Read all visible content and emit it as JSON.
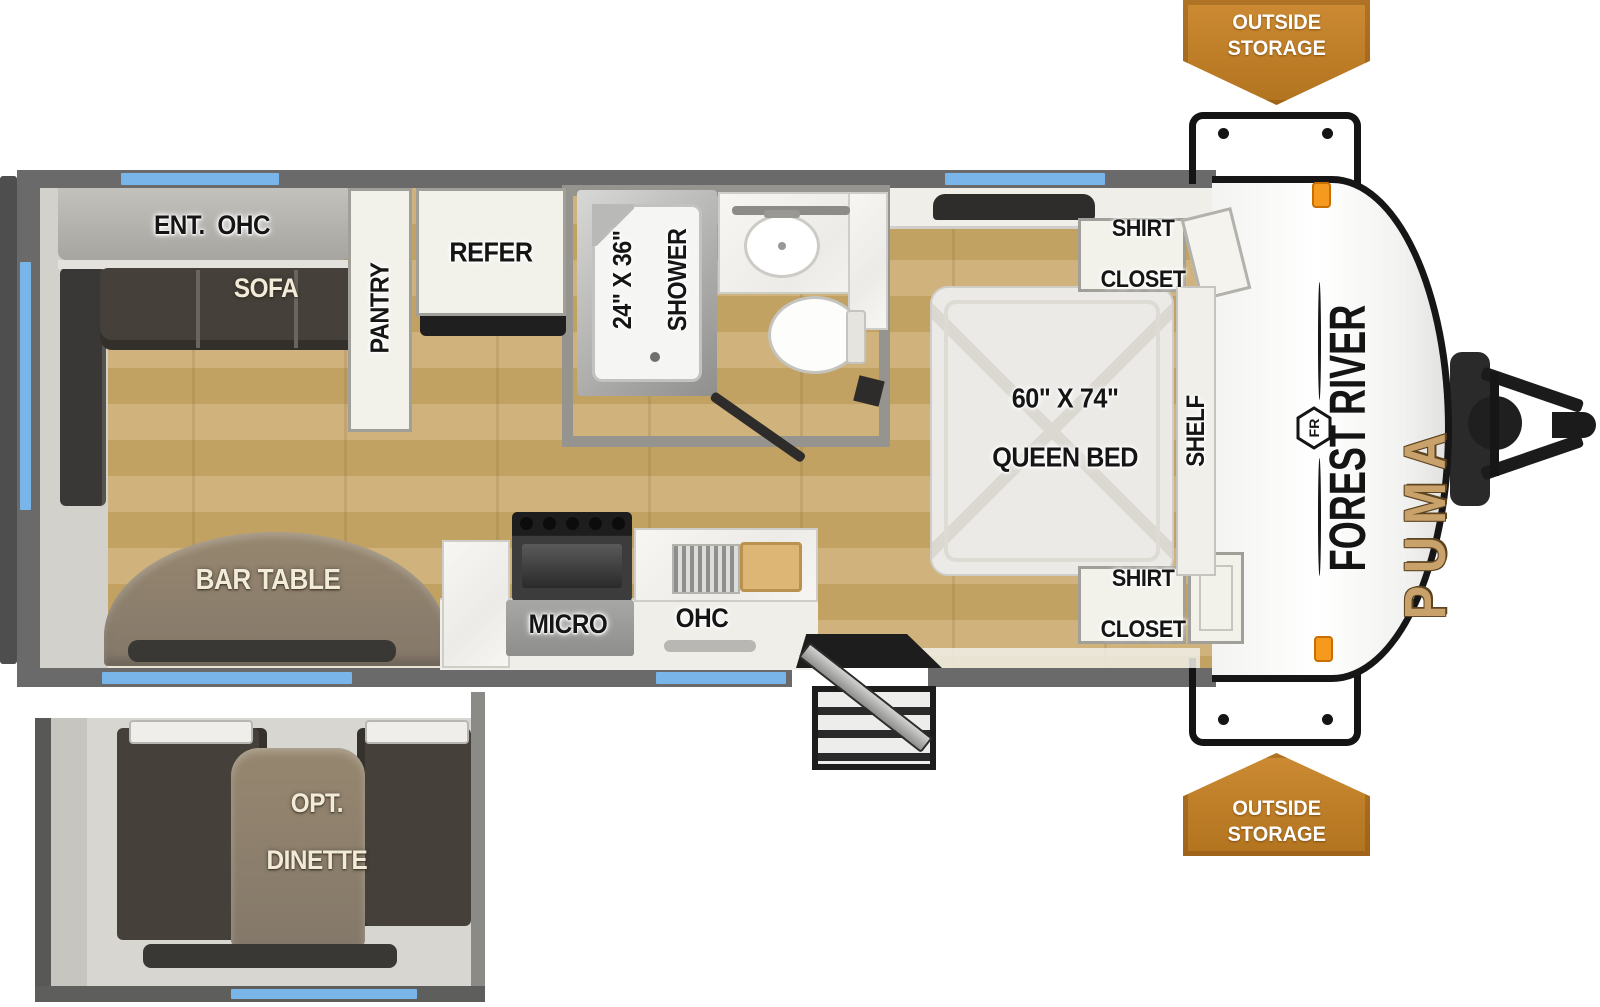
{
  "title": "Forest River Puma travel trailer floorplan",
  "banners": {
    "top_line1": "OUTSIDE",
    "top_line2": "STORAGE",
    "bottom_line1": "OUTSIDE",
    "bottom_line2": "STORAGE"
  },
  "labels": {
    "ent_ohc": "ENT.  OHC",
    "sofa": "SOFA",
    "pantry": "PANTRY",
    "refer": "REFER",
    "shower_size": "24\" X 36\"",
    "shower": "SHOWER",
    "shirt_top_1": "SHIRT",
    "shirt_top_2": "CLOSET",
    "bed_size": "60\" X 74\"",
    "bed": "QUEEN BED",
    "shelf": "SHELF",
    "shirt_bottom_1": "SHIRT",
    "shirt_bottom_2": "CLOSET",
    "bar_table": "BAR TABLE",
    "micro": "MICRO",
    "ohc": "OHC",
    "dinette_1": "OPT.",
    "dinette_2": "DINETTE"
  },
  "brand": {
    "make": "FOREST RIVER",
    "model": "PUMA",
    "logo_monogram": "FR"
  },
  "colors": {
    "banner_orange": "#C0792A",
    "window_blue": "#79B5E8",
    "wall_gray": "#6A6A6A",
    "floor_wood": "#C9AB74",
    "sofa_dark": "#45403A",
    "table_wood": "#8B7C6B",
    "puma_gold": "#C9A26B",
    "marker_orange": "#F59A1E"
  }
}
